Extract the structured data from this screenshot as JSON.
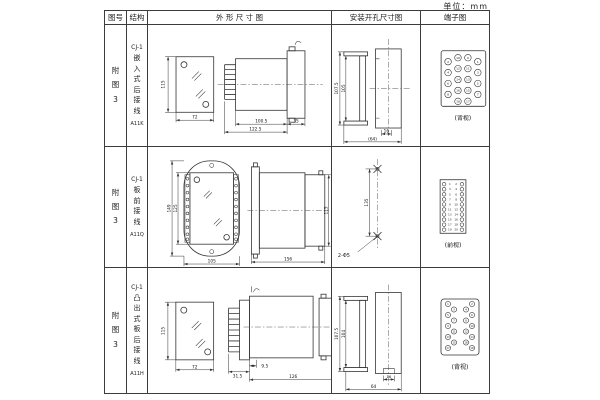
{
  "unit_label": "单位：mm",
  "header": {
    "figure": "图号",
    "structure": "结构",
    "outline": "外 形 尺 寸 图",
    "mounting": "安装开孔尺寸图",
    "terminal": "端子图"
  },
  "rows": [
    {
      "figure_no": "附图3",
      "model": "CJ-1",
      "structure": "嵌入式后接线",
      "code": "A11K",
      "outline": {
        "front_h": "115",
        "front_w": "72",
        "depth": "100.5",
        "total_depth": "122.5",
        "flange": "35"
      },
      "mounting": {
        "outer_h": "107.5",
        "inner_h": "105",
        "slot_w": "16",
        "width": "(64)"
      },
      "terminal": {
        "view": "(背视)",
        "numbers": [
          2,
          4,
          6,
          8,
          10,
          12,
          14,
          16,
          9,
          11,
          13,
          15,
          1,
          3,
          5,
          7,
          18,
          17
        ]
      }
    },
    {
      "figure_no": "附图3",
      "model": "CJ-1",
      "structure": "板前接线",
      "code": "A11Q",
      "outline": {
        "front_h": "149",
        "inner_h": "125",
        "front_w": "105",
        "depth": "156",
        "side_h": "115"
      },
      "mounting": {
        "hole_spacing": "135",
        "hole_note": "2-Φ5"
      },
      "terminal": {
        "view": "(前视)",
        "left_numbers": [
          1,
          3,
          5,
          7,
          9,
          11,
          13,
          15,
          17,
          19
        ],
        "right_numbers": [
          2,
          4,
          6,
          8,
          10,
          12,
          14,
          16,
          18,
          20
        ]
      }
    },
    {
      "figure_no": "附图3",
      "model": "CJ-1",
      "structure": "凸出式板后接线",
      "code": "A11H",
      "outline": {
        "front_h": "115",
        "front_w": "72",
        "stub": "31.5",
        "plate": "9.5",
        "depth": "126"
      },
      "mounting": {
        "outer_h": "107.5",
        "inner_h": "104",
        "slot_w": "16",
        "width": "64"
      },
      "terminal": {
        "view": "(背视)",
        "numbers": [
          1,
          3,
          5,
          7,
          9,
          11,
          13,
          15,
          17,
          2,
          4,
          6,
          8,
          10,
          12,
          14,
          16,
          18
        ]
      }
    }
  ]
}
